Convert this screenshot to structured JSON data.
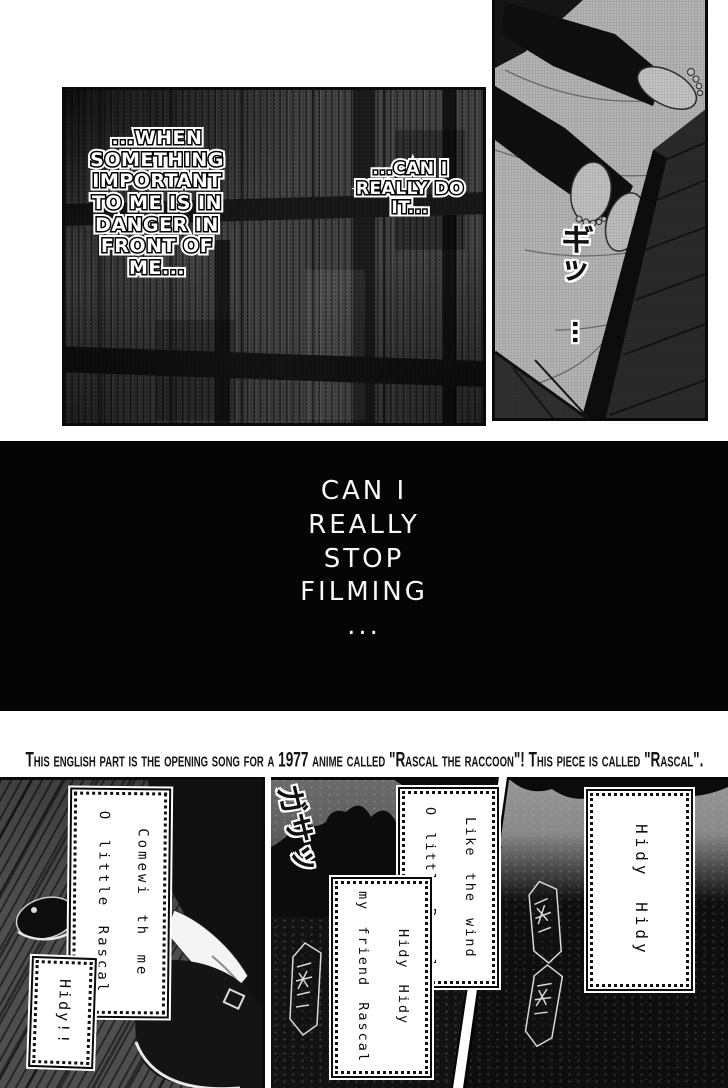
{
  "top_left_panel": {
    "bubble_main": "...WHEN\nSOMETHING\nIMPORTANT\nTO ME IS IN\nDANGER IN\nFRONT OF\nME...",
    "bubble_side": "...CAN I\nREALLY DO\nIT..."
  },
  "top_right_panel": {
    "sfx_creak": "ギッ",
    "sfx_dots": "…"
  },
  "black_panel": {
    "monologue": "CAN I\nREALLY\nSTOP\nFILMING\n..."
  },
  "translator_note": "This english part is the opening song for a 1977 anime called \"Rascal the raccoon\"! This piece is called \"Rascal\".",
  "bottom_left_panel": {
    "lyric_box": "Comewi th me\nO little Rascal",
    "hidy_box": "Hidy!!"
  },
  "bottom_middle_panel": {
    "sfx_rustle": "ガサッ",
    "lyric_box_top": "Like the wind\nO little Rascal",
    "lyric_box_bottom": "Hidy Hidy\nmy friend Rascal"
  },
  "bottom_right_panel": {
    "lyric_box": "Hidy Hidy"
  },
  "colors": {
    "page_bg": "#ffffff",
    "ink": "#0a0a0a",
    "black_panel_bg": "#050505",
    "wood_mid": "#454545",
    "sheet_gray": "#b5b5b5",
    "forest_dark": "#101010",
    "sky_gray": "#6e6e6e"
  }
}
